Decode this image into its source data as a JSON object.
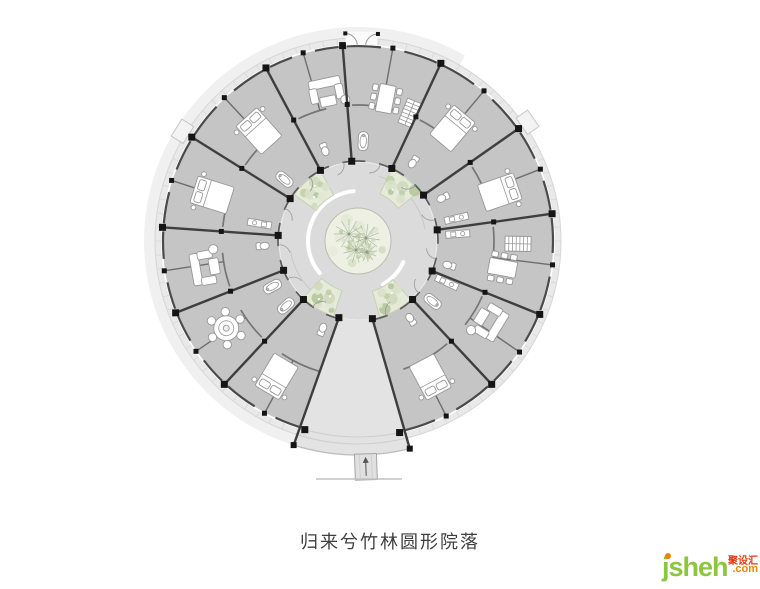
{
  "caption": {
    "text": "归来兮竹林圆形院落",
    "color": "#3f3f3f"
  },
  "watermark": {
    "name": "jsheh",
    "suffix": ".com",
    "cn": "聚设汇",
    "name_color": "#8cc63e",
    "suffix_color": "#f08300",
    "cn_color": "#e8380d",
    "dot_color": "#f08300"
  },
  "plan": {
    "cx": 358,
    "cy": 241,
    "radii": {
      "outer_faint_in": 203,
      "outer_faint_out": 214,
      "veranda": 203,
      "ring": 196,
      "court": 79,
      "trees": 33,
      "court_arc": 50,
      "mid_arc": 136
    },
    "colors": {
      "outer_faint": "#f0f0f0",
      "veranda": "#e9e9e9",
      "veranda_edge": "#d6d6d6",
      "ring": "#c5c5c5",
      "court": "#dbdbdb",
      "wedge": "#e3e3e3",
      "wall": "#3e3e3e",
      "column": "#151515",
      "seg_outer": "#4a4a4a",
      "seg_inner": "#5a5a5a",
      "partition": "#6e6e6e",
      "mid_arc": "#757575",
      "tick": "#d8d8d8",
      "furn_fill": "#ffffff",
      "furn_stroke": "#979797",
      "arc_white": "#ffffff",
      "court_arc_gray": "#c9c9c9",
      "green_base": "#edf0e3",
      "green_edge": "#b9bfae",
      "branch": "#9aa98b",
      "greens": [
        "#ccd8ba",
        "#bdcfa6",
        "#d8e1c9",
        "#b2c69a",
        "#e0e7d2"
      ],
      "tab_fill": "#f3f3f3",
      "tab_edge": "#c7c7c7",
      "ramp_fill": "#e0e0e0",
      "arrow": "#555555",
      "ground": "#c2c2c2",
      "door": "#9a9a9a",
      "wedge_cross": "#cfcfcf",
      "wedge_bottom": "#bdbdbd"
    },
    "walls": [
      22,
      47,
      79.5,
      104,
      133,
      158.5,
      184,
      212,
      242,
      265.5,
      295,
      325,
      352
    ],
    "wedge": {
      "a_in_r": 79.5,
      "a_in_l": 104,
      "a_out_r": 76,
      "a_out_l": 107.5,
      "r_out": 214
    },
    "tabs": [
      212,
      325
    ],
    "court_arcs_white": [
      [
        140,
        265
      ],
      [
        25,
        60
      ]
    ],
    "court_arcs_gray": [
      [
        288,
        350
      ],
      [
        112,
        172
      ]
    ],
    "planters": {
      "angles": [
        229,
        308,
        61,
        121
      ],
      "half": 13,
      "r0": 52,
      "r1": 79
    },
    "crowns": [
      [
        -9,
        -7,
        15
      ],
      [
        8,
        -3,
        14
      ],
      [
        -2,
        9,
        13
      ],
      [
        9,
        11,
        10
      ]
    ],
    "furniture": [
      {
        "type": "bed",
        "a": 121,
        "r": 158
      },
      {
        "type": "bed",
        "a": 197.5,
        "r": 153
      },
      {
        "type": "bed",
        "a": 228,
        "r": 148
      },
      {
        "type": "bed",
        "a": 310,
        "r": 147
      },
      {
        "type": "bed",
        "a": 341,
        "r": 150
      },
      {
        "type": "bed",
        "a": 62,
        "r": 154
      },
      {
        "type": "round-table",
        "a": 146.5,
        "r": 158
      },
      {
        "type": "sofa",
        "a": 170,
        "r": 152
      },
      {
        "type": "sofa",
        "a": 258,
        "r": 149
      },
      {
        "type": "sofa",
        "a": 31.5,
        "r": 151
      },
      {
        "type": "dining",
        "a": 281,
        "r": 145
      },
      {
        "type": "dining",
        "a": 10.5,
        "r": 147
      },
      {
        "type": "stair",
        "a": 292,
        "r": 138
      },
      {
        "type": "stair",
        "a": 1,
        "r": 160
      },
      {
        "type": "wc",
        "a": 112,
        "r": 96
      },
      {
        "type": "wc",
        "a": 177,
        "r": 96
      },
      {
        "type": "wc",
        "a": 250,
        "r": 98
      },
      {
        "type": "wc",
        "a": 305,
        "r": 97
      },
      {
        "type": "wc",
        "a": 333,
        "r": 96
      },
      {
        "type": "wc",
        "a": 15,
        "r": 95
      },
      {
        "type": "wc",
        "a": 56,
        "r": 95
      },
      {
        "type": "tub",
        "a": 138,
        "r": 97
      },
      {
        "type": "tub",
        "a": 220,
        "r": 96
      },
      {
        "type": "tub",
        "a": 273,
        "r": 100
      },
      {
        "type": "tub",
        "a": 39,
        "r": 96
      },
      {
        "type": "tub",
        "a": 152,
        "r": 97
      },
      {
        "type": "counter",
        "a": 190,
        "r": 100
      },
      {
        "type": "counter",
        "a": 347,
        "r": 101
      },
      {
        "type": "counter",
        "a": 356,
        "r": 100
      },
      {
        "type": "counter",
        "a": 25,
        "r": 98
      }
    ],
    "ramp": {
      "a": 88,
      "r": 226
    },
    "ground_line": {
      "x1": 316,
      "y1": 479,
      "x2": 402,
      "y2": 479
    },
    "door": {
      "hinge_r": 208,
      "a0": 266.5,
      "a1": 275.5,
      "leaf": 12.5
    }
  }
}
